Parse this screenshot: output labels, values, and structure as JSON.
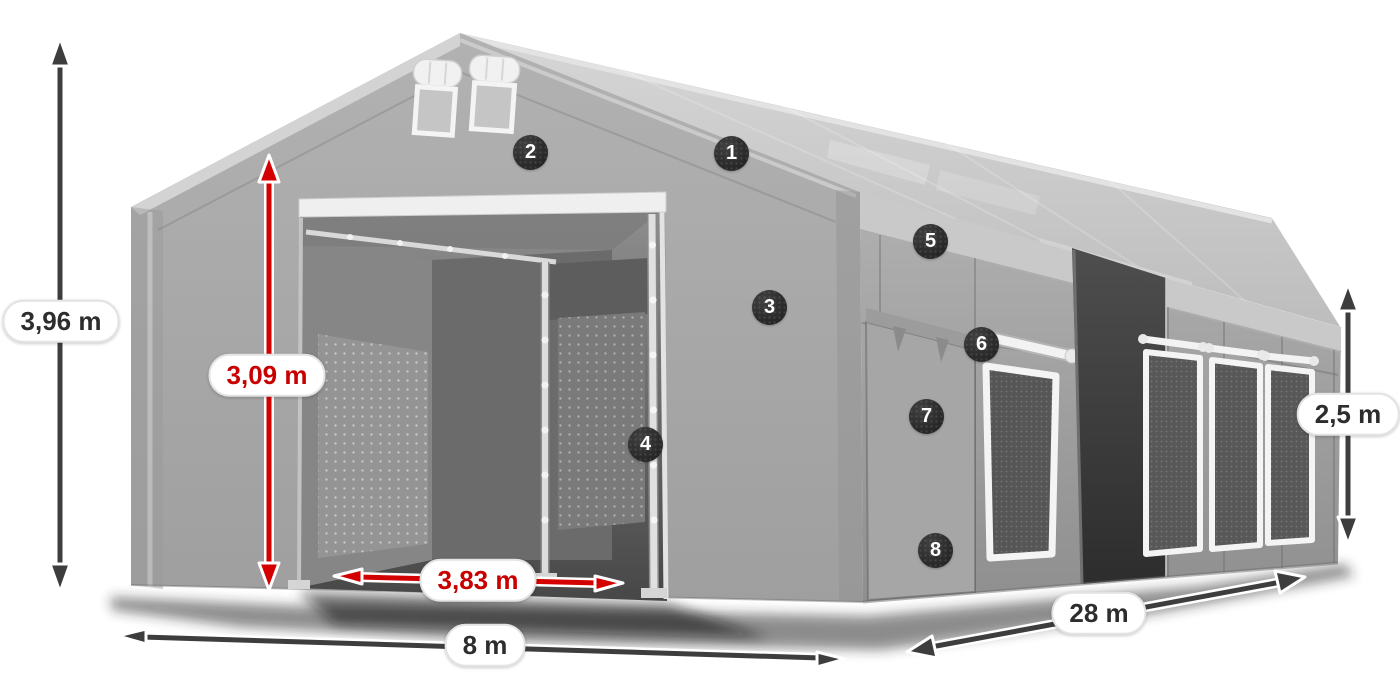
{
  "illustration": {
    "description": "Gray PVC storage tent 3D product view with numbered feature markers and dimension arrows",
    "colors": {
      "accent_red": "#d40000",
      "arrow_dark": "#3d3d3d",
      "marker_bg": "#262626",
      "marker_text": "#ffffff",
      "label_bg": "#ffffff",
      "label_border": "#e3e3e3",
      "label_text_dark": "#2d2d2d",
      "label_text_red": "#c80000"
    },
    "markers": {
      "m1": "1",
      "m2": "2",
      "m3": "3",
      "m4": "4",
      "m5": "5",
      "m6": "6",
      "m7": "7",
      "m8": "8"
    },
    "dimensions": {
      "total_height": "3,96 m",
      "entrance_height": "3,09 m",
      "entrance_width": "3,83 m",
      "gable_width": "8 m",
      "length": "28 m",
      "side_wall_height": "2,5 m"
    }
  }
}
